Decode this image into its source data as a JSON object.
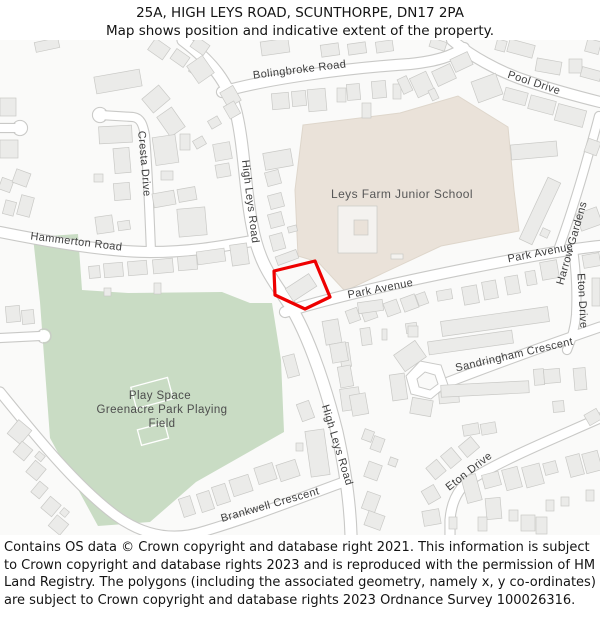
{
  "header": {
    "title": "25A, HIGH LEYS ROAD, SCUNTHORPE, DN17 2PA",
    "subtitle": "Map shows position and indicative extent of the property."
  },
  "footer": {
    "text": "Contains OS data © Crown copyright and database right 2021. This information is subject to Crown copyright and database rights 2023 and is reproduced with the permission of HM Land Registry. The polygons (including the associated geometry, namely x, y co-ordinates) are subject to Crown copyright and database rights 2023 Ordnance Survey 100026316."
  },
  "map": {
    "colors": {
      "land": "#fafaf9",
      "green": "#c9dcc4",
      "school": "#eae2d9",
      "school_edge": "#ded6cb",
      "road_casing": "#c9c9c7",
      "road_fill": "#ffffff",
      "building": "#ebebe9",
      "building_edge": "#c9c9c6",
      "label": "#3e3e3e",
      "plot_red": "#ee0000"
    },
    "areas": {
      "green": "33,197 78,194 82,250 128,253 222,252 250,263 272,263 281,320 284,392 196,442 150,482 98,486 50,398 40,262",
      "school": "303,85 400,73 458,56 508,87 514,150 519,191 441,206 345,251 318,222 298,216 295,150",
      "pitches": [
        [
          133,
          342,
          38,
          22,
          -15
        ],
        [
          139,
          386,
          28,
          16,
          -15
        ]
      ]
    },
    "loop": {
      "outer": "406,336 420,321 441,325 448,345 431,359 411,354",
      "inner": "417,339 425,332 435,335 438,344 430,350 419,347"
    },
    "roads": [
      {
        "d": "M222,52 C270,38 350,28 410,24 C438,21 452,16 464,8",
        "w": 10
      },
      {
        "d": "M452,0 C468,14 498,32 530,42 C560,52 584,58 600,62",
        "w": 10
      },
      {
        "d": "M183,0 C212,22 228,42 236,72 C244,104 245,150 252,185 C258,218 268,234 285,258 C305,286 324,340 337,392 C344,424 350,460 351,495",
        "w": 11
      },
      {
        "d": "M100,75 L133,77 C141,78 143,85 145,95 C147,120 149,160 151,212",
        "w": 8
      },
      {
        "d": "M0,88 L16,88",
        "w": 8
      },
      {
        "d": "M0,192 C50,202 110,212 150,212 C190,212 218,207 252,201",
        "w": 10
      },
      {
        "d": "M285,272 C330,258 400,242 470,228 C530,216 570,209 600,206",
        "w": 10
      },
      {
        "d": "M557,213 C567,186 578,152 588,116 C592,102 596,88 599,76",
        "w": 8
      },
      {
        "d": "M573,209 C576,230 577,255 576,275 C575,288 572,298 567,310",
        "w": 8
      },
      {
        "d": "M446,343 C490,326 545,306 600,287",
        "w": 9
      },
      {
        "d": "M600,378 C560,396 505,418 470,440 C456,450 451,466 450,480 L450,495",
        "w": 9
      },
      {
        "d": "M0,352 C35,395 75,445 115,475 C145,497 175,501 205,491 C255,476 300,458 341,443",
        "w": 9
      },
      {
        "d": "M0,298 L40,296",
        "w": 8
      }
    ],
    "culdesacs": [
      [
        100,
        75,
        6.5
      ],
      [
        20,
        88,
        6.5
      ],
      [
        44,
        296,
        6
      ]
    ],
    "plot": {
      "points": "274,231 315,221 330,257 305,269 275,255"
    },
    "buildings": [
      [
        35,
        0,
        24,
        10,
        -12
      ],
      [
        150,
        2,
        18,
        14,
        35
      ],
      [
        172,
        12,
        16,
        12,
        35
      ],
      [
        192,
        0,
        16,
        12,
        35
      ],
      [
        190,
        26,
        14,
        10,
        35
      ],
      [
        430,
        0,
        16,
        9,
        18
      ],
      [
        261,
        0,
        28,
        14,
        -8
      ],
      [
        321,
        4,
        18,
        12,
        -8
      ],
      [
        348,
        3,
        18,
        11,
        -8
      ],
      [
        376,
        1,
        17,
        11,
        -8
      ],
      [
        496,
        0,
        10,
        11,
        15
      ],
      [
        508,
        2,
        26,
        13,
        15
      ],
      [
        586,
        0,
        14,
        13,
        15
      ],
      [
        95,
        33,
        46,
        17,
        -10
      ],
      [
        145,
        50,
        22,
        18,
        -40
      ],
      [
        162,
        70,
        18,
        24,
        -35
      ],
      [
        0,
        58,
        16,
        18,
        0
      ],
      [
        0,
        100,
        18,
        18,
        0
      ],
      [
        99,
        86,
        33,
        17,
        -3
      ],
      [
        114,
        108,
        16,
        25,
        -5
      ],
      [
        114,
        143,
        16,
        17,
        -5
      ],
      [
        94,
        134,
        9,
        8,
        0
      ],
      [
        154,
        96,
        23,
        28,
        -8
      ],
      [
        161,
        131,
        12,
        9,
        0
      ],
      [
        191,
        19,
        19,
        21,
        -35
      ],
      [
        223,
        48,
        15,
        17,
        -30
      ],
      [
        226,
        63,
        12,
        14,
        -30
      ],
      [
        209,
        78,
        11,
        9,
        -30
      ],
      [
        194,
        98,
        11,
        9,
        -30
      ],
      [
        214,
        103,
        17,
        17,
        -10
      ],
      [
        216,
        124,
        14,
        13,
        -10
      ],
      [
        180,
        94,
        10,
        16,
        0
      ],
      [
        272,
        53,
        17,
        16,
        -5
      ],
      [
        292,
        51,
        14,
        15,
        -5
      ],
      [
        308,
        49,
        18,
        22,
        -5
      ],
      [
        337,
        48,
        9,
        14,
        0
      ],
      [
        347,
        44,
        13,
        16,
        -5
      ],
      [
        362,
        63,
        9,
        15,
        0
      ],
      [
        372,
        41,
        14,
        17,
        -5
      ],
      [
        393,
        44,
        8,
        15,
        0
      ],
      [
        434,
        27,
        20,
        16,
        -25
      ],
      [
        452,
        15,
        19,
        14,
        -25
      ],
      [
        413,
        34,
        18,
        21,
        -25
      ],
      [
        400,
        37,
        10,
        16,
        -25
      ],
      [
        430,
        49,
        7,
        11,
        -25
      ],
      [
        474,
        37,
        26,
        22,
        -20
      ],
      [
        504,
        50,
        23,
        13,
        15
      ],
      [
        529,
        58,
        26,
        14,
        15
      ],
      [
        556,
        67,
        29,
        17,
        15
      ],
      [
        536,
        20,
        25,
        13,
        10
      ],
      [
        569,
        19,
        13,
        14,
        0
      ],
      [
        581,
        29,
        20,
        10,
        15
      ],
      [
        586,
        100,
        13,
        14,
        20
      ],
      [
        511,
        103,
        46,
        15,
        -5
      ],
      [
        533,
        137,
        14,
        68,
        25
      ],
      [
        541,
        189,
        8,
        8,
        25
      ],
      [
        578,
        170,
        22,
        18,
        -20
      ],
      [
        264,
        111,
        28,
        17,
        -10
      ],
      [
        266,
        131,
        14,
        14,
        -15
      ],
      [
        269,
        154,
        14,
        14,
        -15
      ],
      [
        269,
        173,
        14,
        14,
        -15
      ],
      [
        288,
        186,
        9,
        6,
        -15
      ],
      [
        271,
        194,
        13,
        16,
        -15
      ],
      [
        276,
        213,
        22,
        9,
        -20
      ],
      [
        178,
        168,
        28,
        28,
        -5
      ],
      [
        153,
        152,
        22,
        14,
        -10
      ],
      [
        178,
        148,
        18,
        13,
        -10
      ],
      [
        0,
        139,
        12,
        12,
        20
      ],
      [
        14,
        131,
        15,
        14,
        20
      ],
      [
        19,
        156,
        13,
        20,
        15
      ],
      [
        4,
        161,
        11,
        14,
        15
      ],
      [
        96,
        176,
        17,
        17,
        -8
      ],
      [
        118,
        181,
        12,
        9,
        -8
      ],
      [
        89,
        226,
        11,
        12,
        -5
      ],
      [
        104,
        223,
        19,
        14,
        -5
      ],
      [
        128,
        221,
        19,
        14,
        -5
      ],
      [
        153,
        219,
        20,
        14,
        -5
      ],
      [
        178,
        216,
        19,
        14,
        -5
      ],
      [
        197,
        210,
        28,
        13,
        -8
      ],
      [
        231,
        206,
        14,
        11,
        -8
      ],
      [
        104,
        248,
        7,
        8,
        0
      ],
      [
        154,
        243,
        7,
        11,
        0
      ],
      [
        6,
        266,
        14,
        16,
        -5
      ],
      [
        22,
        270,
        12,
        14,
        -5
      ],
      [
        231,
        204,
        17,
        21,
        -8
      ],
      [
        338,
        166,
        39,
        47,
        0,
        "#f4f2ef"
      ],
      [
        354,
        180,
        14,
        15,
        0,
        "#eae2d9"
      ],
      [
        391,
        214,
        12,
        5,
        0,
        "#f4f2ef"
      ],
      [
        287,
        240,
        28,
        15,
        -33
      ],
      [
        347,
        269,
        12,
        13,
        -20
      ],
      [
        362,
        266,
        14,
        14,
        -20
      ],
      [
        385,
        261,
        14,
        14,
        -20
      ],
      [
        402,
        256,
        15,
        14,
        -20
      ],
      [
        417,
        253,
        10,
        12,
        -20
      ],
      [
        437,
        250,
        15,
        10,
        -10
      ],
      [
        463,
        246,
        15,
        18,
        -10
      ],
      [
        483,
        241,
        14,
        18,
        -10
      ],
      [
        506,
        236,
        13,
        18,
        -10
      ],
      [
        526,
        231,
        10,
        14,
        -10
      ],
      [
        541,
        221,
        17,
        18,
        -10
      ],
      [
        583,
        214,
        17,
        13,
        -10
      ],
      [
        592,
        238,
        8,
        28,
        0
      ],
      [
        441,
        274,
        108,
        15,
        -8
      ],
      [
        428,
        296,
        85,
        13,
        -8
      ],
      [
        406,
        283,
        11,
        10,
        -8
      ],
      [
        361,
        288,
        10,
        17,
        -8
      ],
      [
        382,
        289,
        5,
        11,
        0
      ],
      [
        397,
        306,
        26,
        20,
        -35
      ],
      [
        391,
        334,
        15,
        26,
        -8
      ],
      [
        340,
        303,
        10,
        24,
        -8
      ],
      [
        341,
        348,
        19,
        22,
        -8
      ],
      [
        358,
        261,
        25,
        11,
        -8
      ],
      [
        408,
        286,
        10,
        11,
        0
      ],
      [
        439,
        352,
        20,
        11,
        -5
      ],
      [
        285,
        315,
        12,
        22,
        -15
      ],
      [
        299,
        362,
        13,
        18,
        -20
      ],
      [
        324,
        280,
        16,
        24,
        -10
      ],
      [
        331,
        303,
        16,
        19,
        -10
      ],
      [
        339,
        326,
        13,
        21,
        -10
      ],
      [
        351,
        354,
        16,
        21,
        -10
      ],
      [
        411,
        359,
        21,
        16,
        10
      ],
      [
        441,
        343,
        88,
        12,
        -3
      ],
      [
        534,
        329,
        10,
        16,
        -5
      ],
      [
        544,
        329,
        16,
        14,
        -5
      ],
      [
        574,
        328,
        12,
        22,
        -5
      ],
      [
        586,
        371,
        14,
        12,
        -30
      ],
      [
        553,
        361,
        11,
        11,
        -5
      ],
      [
        463,
        384,
        16,
        11,
        -10
      ],
      [
        481,
        383,
        15,
        11,
        -10
      ],
      [
        11,
        383,
        17,
        18,
        40
      ],
      [
        16,
        404,
        14,
        14,
        40
      ],
      [
        29,
        423,
        14,
        15,
        40
      ],
      [
        34,
        443,
        11,
        14,
        40
      ],
      [
        44,
        459,
        14,
        15,
        40
      ],
      [
        51,
        478,
        15,
        14,
        40
      ],
      [
        36,
        413,
        8,
        7,
        40
      ],
      [
        61,
        469,
        7,
        7,
        40
      ],
      [
        231,
        437,
        20,
        17,
        -18
      ],
      [
        256,
        425,
        19,
        17,
        -18
      ],
      [
        278,
        422,
        20,
        17,
        -18
      ],
      [
        214,
        445,
        14,
        19,
        -18
      ],
      [
        199,
        452,
        13,
        19,
        -18
      ],
      [
        181,
        457,
        12,
        19,
        -18
      ],
      [
        308,
        390,
        19,
        46,
        -8
      ],
      [
        296,
        403,
        7,
        8,
        0
      ],
      [
        363,
        390,
        10,
        11,
        20
      ],
      [
        372,
        397,
        11,
        14,
        20
      ],
      [
        366,
        423,
        14,
        16,
        20
      ],
      [
        389,
        418,
        8,
        8,
        20
      ],
      [
        364,
        453,
        14,
        18,
        20
      ],
      [
        366,
        473,
        17,
        15,
        20
      ],
      [
        429,
        422,
        14,
        15,
        -40
      ],
      [
        444,
        410,
        14,
        16,
        -40
      ],
      [
        461,
        400,
        16,
        14,
        -40
      ],
      [
        424,
        447,
        14,
        15,
        -30
      ],
      [
        423,
        470,
        17,
        15,
        -10
      ],
      [
        464,
        435,
        15,
        27,
        -15
      ],
      [
        483,
        433,
        17,
        14,
        -15
      ],
      [
        486,
        458,
        15,
        21,
        -5
      ],
      [
        504,
        428,
        16,
        21,
        -15
      ],
      [
        524,
        425,
        18,
        21,
        -15
      ],
      [
        544,
        422,
        13,
        12,
        -15
      ],
      [
        568,
        415,
        14,
        21,
        -15
      ],
      [
        584,
        412,
        16,
        20,
        -15
      ],
      [
        546,
        460,
        8,
        11,
        0
      ],
      [
        561,
        457,
        8,
        9,
        0
      ],
      [
        586,
        450,
        8,
        11,
        0
      ],
      [
        509,
        470,
        9,
        11,
        0
      ],
      [
        521,
        475,
        14,
        16,
        0
      ],
      [
        536,
        477,
        11,
        17,
        0
      ],
      [
        478,
        477,
        9,
        14,
        0
      ],
      [
        449,
        477,
        8,
        12,
        0
      ]
    ],
    "labels": [
      {
        "t": "Bolingbroke Road",
        "x": 300,
        "y": 33,
        "r": -7
      },
      {
        "t": "Pool Drive",
        "x": 533,
        "y": 46,
        "r": 18
      },
      {
        "t": "Cresta Drive",
        "x": 141,
        "y": 124,
        "r": 85
      },
      {
        "t": "High Leys Road",
        "x": 247,
        "y": 162,
        "r": 83
      },
      {
        "t": "Hammerton Road",
        "x": 76,
        "y": 205,
        "r": 7
      },
      {
        "t": "Park Avenue",
        "x": 381,
        "y": 252,
        "r": -11
      },
      {
        "t": "Park Avenue",
        "x": 541,
        "y": 216,
        "r": -11
      },
      {
        "t": "Harrow Gardens",
        "x": 575,
        "y": 204,
        "r": -74
      },
      {
        "t": "Eton Drive",
        "x": 579,
        "y": 261,
        "r": 87
      },
      {
        "t": "Sandringham Crescent",
        "x": 515,
        "y": 318,
        "r": -13
      },
      {
        "t": "High Leys Road",
        "x": 334,
        "y": 406,
        "r": 73
      },
      {
        "t": "Eton Drive",
        "x": 471,
        "y": 434,
        "r": -38
      },
      {
        "t": "Brankwell Crescent",
        "x": 271,
        "y": 468,
        "r": -16
      },
      {
        "t": "Leys Farm Junior School",
        "x": 402,
        "y": 158,
        "r": 0,
        "s": 12,
        "c": "#575757",
        "n": "school-label"
      },
      {
        "t": "Play Space",
        "x": 160,
        "y": 359,
        "s": 11.5,
        "c": "#4d4d4d",
        "n": "playing-field-label"
      },
      {
        "t": "Greenacre Park Playing",
        "x": 162,
        "y": 373,
        "s": 11.5,
        "c": "#4d4d4d",
        "n": "playing-field-label"
      },
      {
        "t": "Field",
        "x": 162,
        "y": 387,
        "s": 11.5,
        "c": "#4d4d4d",
        "n": "playing-field-label"
      }
    ]
  }
}
